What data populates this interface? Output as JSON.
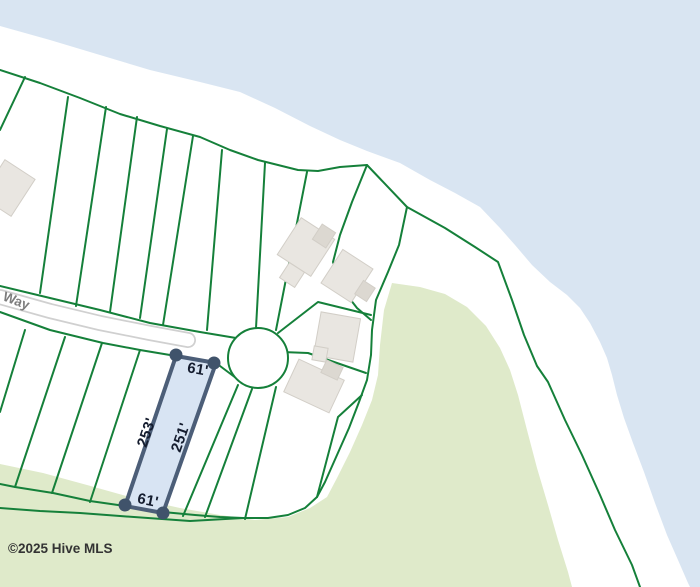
{
  "map": {
    "street_label": "Way",
    "selected_lot": {
      "dim_top": "61'",
      "dim_bottom": "61'",
      "dim_left": "253'",
      "dim_right": "251'"
    },
    "attribution": "©2025 Hive MLS"
  },
  "colors": {
    "water": "#d9e5f2",
    "land": "#ffffff",
    "vegetation": "#dfeaca",
    "parcel_line": "#15803a",
    "road_casing": "#d0d0d0",
    "road_fill": "#ffffff",
    "building_fill": "#e9e6e1",
    "building_shade": "#dcd8d1",
    "building_stroke": "#d2cec7",
    "lot_fill": "#d8e4f3",
    "lot_stroke": "#4c5e78",
    "lot_corner_dot": "#40536b",
    "dimension_text": "#141c2e",
    "street_text": "#7d7d7d",
    "attribution_text": "#333333"
  }
}
